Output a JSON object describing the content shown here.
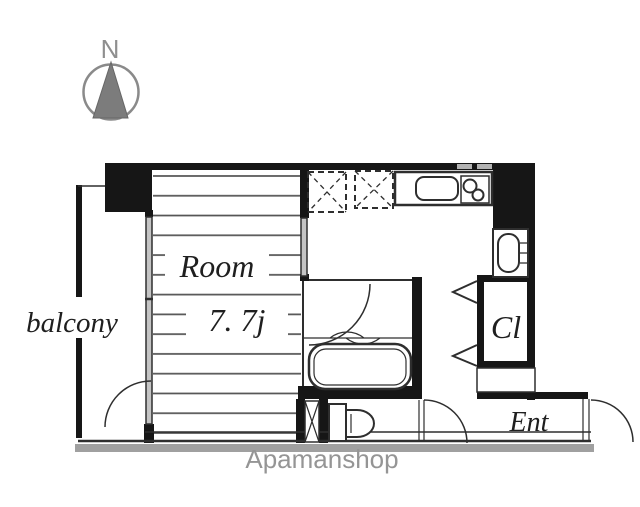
{
  "compass": {
    "north_label": "N"
  },
  "plan": {
    "balcony_label": "balcony",
    "room_label": "Room",
    "room_size_label": "7. 7j",
    "closet_label": "Cl",
    "entrance_label": "Ent"
  },
  "watermark": "Apamanshop",
  "colors": {
    "wall": "#161616",
    "line": "#2e2e2e",
    "tatami": "#555555",
    "window": "#c4c4c4",
    "shadow": "#a0a0a0",
    "watermark": "#959595",
    "compass": "#7c7c7c",
    "label": "#1f1f1f"
  }
}
